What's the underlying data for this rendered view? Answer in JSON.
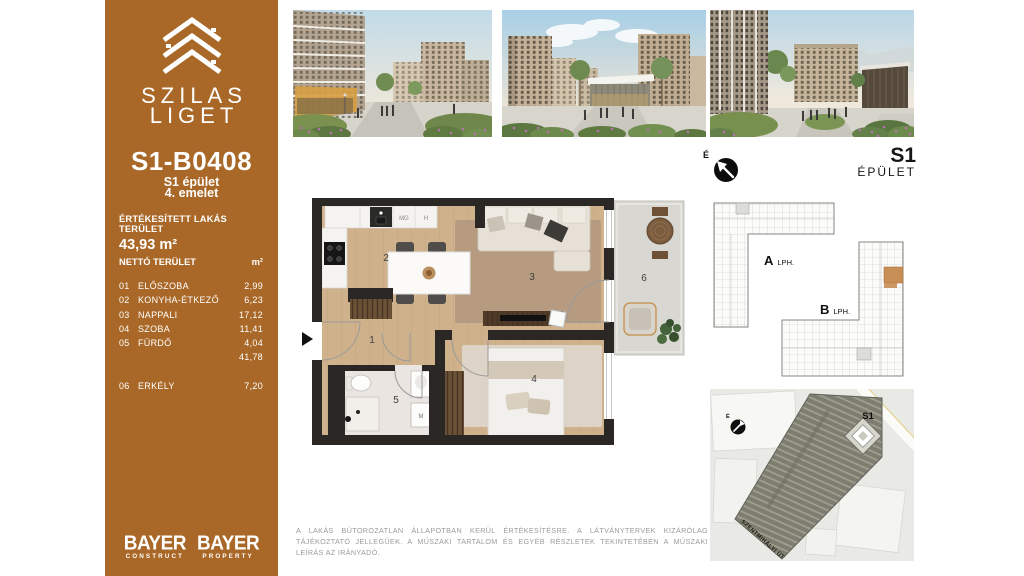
{
  "sidebar": {
    "brand_line1": "SZILAS",
    "brand_line2": "LIGET",
    "unit_id": "S1-B0408",
    "building": "S1 épület",
    "floor": "4. emelet",
    "sold_area_label": "ÉRTÉKESÍTETT LAKÁS TERÜLET",
    "sold_area_value": "43,93 m²",
    "net_label": "NETTÓ TERÜLET",
    "net_unit": "m²",
    "rooms": [
      {
        "num": "01",
        "name": "ELŐSZOBA",
        "area": "2,99"
      },
      {
        "num": "02",
        "name": "KONYHA-ÉTKEZŐ",
        "area": "6,23"
      },
      {
        "num": "03",
        "name": "NAPPALI",
        "area": "17,12"
      },
      {
        "num": "04",
        "name": "SZOBA",
        "area": "11,41"
      },
      {
        "num": "05",
        "name": "FÜRDŐ",
        "area": "4,04"
      }
    ],
    "net_total": "41,78",
    "balcony_row": {
      "num": "06",
      "name": "ERKÉLY",
      "area": "7,20"
    },
    "logos": [
      {
        "name": "BAYER",
        "division": "CONSTRUCT"
      },
      {
        "name": "BAYER",
        "division": "PROPERTY"
      }
    ]
  },
  "building_key": {
    "compass": "É",
    "title": "S1",
    "subtitle": "ÉPÜLET",
    "stairwells": [
      {
        "letter": "A",
        "label": "LPH."
      },
      {
        "letter": "B",
        "label": "LPH."
      }
    ]
  },
  "floor_plan": {
    "room_labels": [
      "1",
      "2",
      "3",
      "4",
      "5",
      "6"
    ],
    "fixtures": {
      "dishwasher": "MG",
      "fridge": "H",
      "washing_machine": "M"
    }
  },
  "site_map": {
    "compass": "É",
    "building_label": "S1",
    "street": "SZENTMIHÁLYI ÚT"
  },
  "disclaimer": "A LAKÁS BÚTOROZATLAN ÁLLAPOTBAN KERÜL ÉRTÉKESÍTÉSRE. A LÁTVÁNYTERVEK KIZÁRÓLAG TÁJÉKOZTATÓ JELLEGŰEK. A MŰSZAKI TARTALOM ÉS EGYÉB RÉSZLETEK TEKINTETÉBEN A MŰSZAKI LEÍRÁS AZ IRÁNYADÓ.",
  "icons": {
    "logo": "roof-chevrons-icon",
    "compass": "north-compass-icon",
    "entrance": "entrance-arrow-icon"
  },
  "colors": {
    "sidebar": "#a96827",
    "highlight_unit": "#c78e55",
    "wall": "#2b2724",
    "wood_floor": "#cfb28c",
    "tile_floor": "#eae5e0",
    "balcony_floor": "#d8d7d2"
  }
}
